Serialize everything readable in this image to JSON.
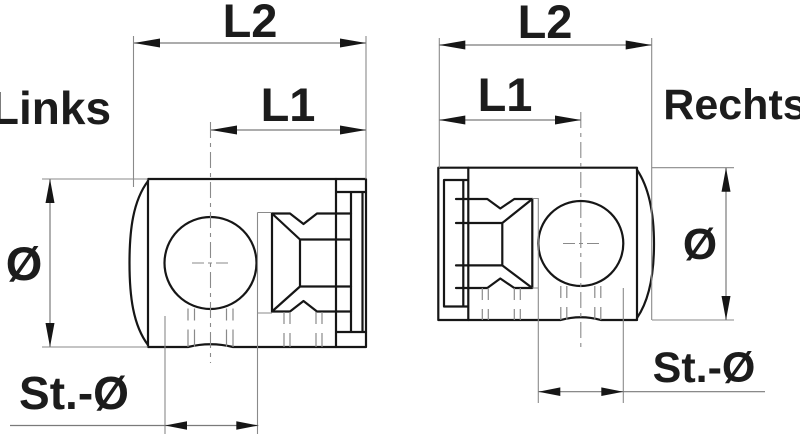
{
  "drawing": {
    "type": "technical-drawing",
    "background": "#ffffff",
    "line_color": "#161616",
    "thin_line_color": "#8a8a8a",
    "views": {
      "left": {
        "label": "Links",
        "dim_l2": "L2",
        "dim_l1": "L1",
        "dim_diameter": "Ø",
        "dim_rod_diameter": "St.-Ø"
      },
      "right": {
        "label": "Rechts",
        "dim_l2": "L2",
        "dim_l1": "L1",
        "dim_diameter": "Ø",
        "dim_rod_diameter": "St.-Ø"
      }
    }
  }
}
